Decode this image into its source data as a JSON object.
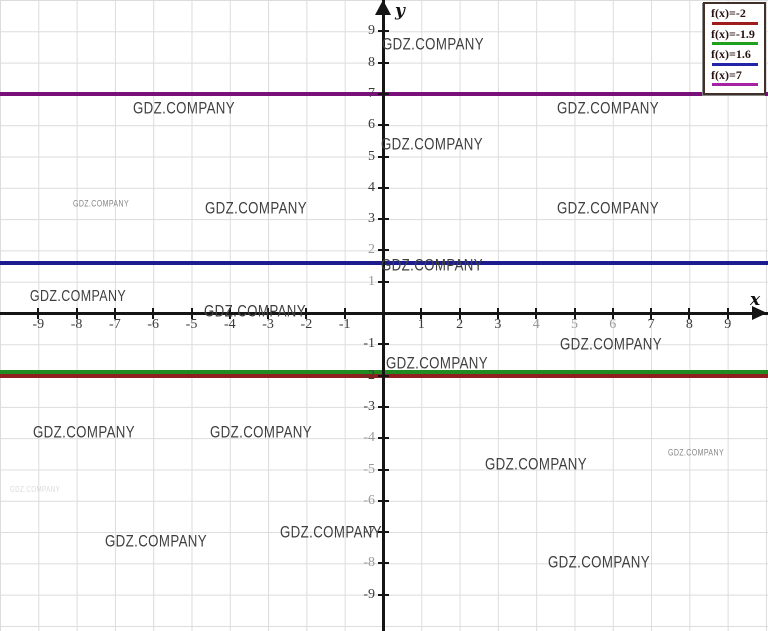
{
  "watermarks": {
    "text": "GDZ.COMPANY",
    "items": [
      {
        "x": 433,
        "y": 44,
        "size": 17,
        "tone": "normal"
      },
      {
        "x": 184,
        "y": 108,
        "size": 17,
        "tone": "normal"
      },
      {
        "x": 608,
        "y": 108,
        "size": 17,
        "tone": "normal"
      },
      {
        "x": 432,
        "y": 144,
        "size": 17,
        "tone": "normal"
      },
      {
        "x": 101,
        "y": 204,
        "size": 9,
        "tone": "muted"
      },
      {
        "x": 256,
        "y": 208,
        "size": 17,
        "tone": "normal"
      },
      {
        "x": 608,
        "y": 208,
        "size": 17,
        "tone": "normal"
      },
      {
        "x": 432,
        "y": 265,
        "size": 17,
        "tone": "normal"
      },
      {
        "x": 78,
        "y": 297,
        "size": 16,
        "tone": "normal"
      },
      {
        "x": 255,
        "y": 311,
        "size": 17,
        "tone": "normal"
      },
      {
        "x": 611,
        "y": 344,
        "size": 17,
        "tone": "normal"
      },
      {
        "x": 437,
        "y": 363,
        "size": 17,
        "tone": "normal"
      },
      {
        "x": 84,
        "y": 432,
        "size": 17,
        "tone": "normal"
      },
      {
        "x": 261,
        "y": 432,
        "size": 17,
        "tone": "normal"
      },
      {
        "x": 536,
        "y": 464,
        "size": 17,
        "tone": "normal"
      },
      {
        "x": 696,
        "y": 453,
        "size": 9,
        "tone": "muted"
      },
      {
        "x": 156,
        "y": 541,
        "size": 17,
        "tone": "normal"
      },
      {
        "x": 331,
        "y": 532,
        "size": 17,
        "tone": "normal"
      },
      {
        "x": 599,
        "y": 562,
        "size": 17,
        "tone": "normal"
      },
      {
        "x": 35,
        "y": 490,
        "size": 8,
        "tone": "faint"
      }
    ]
  },
  "legend": {
    "entries": [
      {
        "label": "f(x)=-2",
        "color": "#9e1c1c"
      },
      {
        "label": "f(x)=-1.9",
        "color": "#1fa11f"
      },
      {
        "label": "f(x)=1.6",
        "color": "#2424a8"
      },
      {
        "label": "f(x)=7",
        "color": "#a522a5"
      }
    ]
  },
  "chart_data": {
    "type": "line",
    "title": "",
    "xlabel": "x",
    "ylabel": "y",
    "xlim": [
      -10,
      10
    ],
    "ylim": [
      -10,
      10
    ],
    "grid": true,
    "legend_position": "top-right",
    "x_ticks": [
      -9,
      -8,
      -7,
      -6,
      -5,
      -4,
      -3,
      -2,
      -1,
      1,
      2,
      3,
      4,
      5,
      6,
      7,
      8,
      9
    ],
    "y_ticks": [
      -9,
      -8,
      -7,
      -6,
      -5,
      -4,
      -3,
      -2,
      -1,
      1,
      2,
      3,
      4,
      5,
      6,
      7,
      8,
      9
    ],
    "x_ticks_muted": [
      4,
      5,
      6
    ],
    "y_ticks_muted": [
      1,
      2,
      -4,
      -5,
      -6,
      -8
    ],
    "series": [
      {
        "name": "f(x)=-2",
        "type": "horizontal-line",
        "y": -2,
        "color": "#8f1f1f"
      },
      {
        "name": "f(x)=-1.9",
        "type": "horizontal-line",
        "y": -1.9,
        "color": "#1f8a1f"
      },
      {
        "name": "f(x)=1.6",
        "type": "horizontal-line",
        "y": 1.6,
        "color": "#1c1c8f"
      },
      {
        "name": "f(x)=7",
        "type": "horizontal-line",
        "y": 7,
        "color": "#7a107a"
      }
    ]
  }
}
